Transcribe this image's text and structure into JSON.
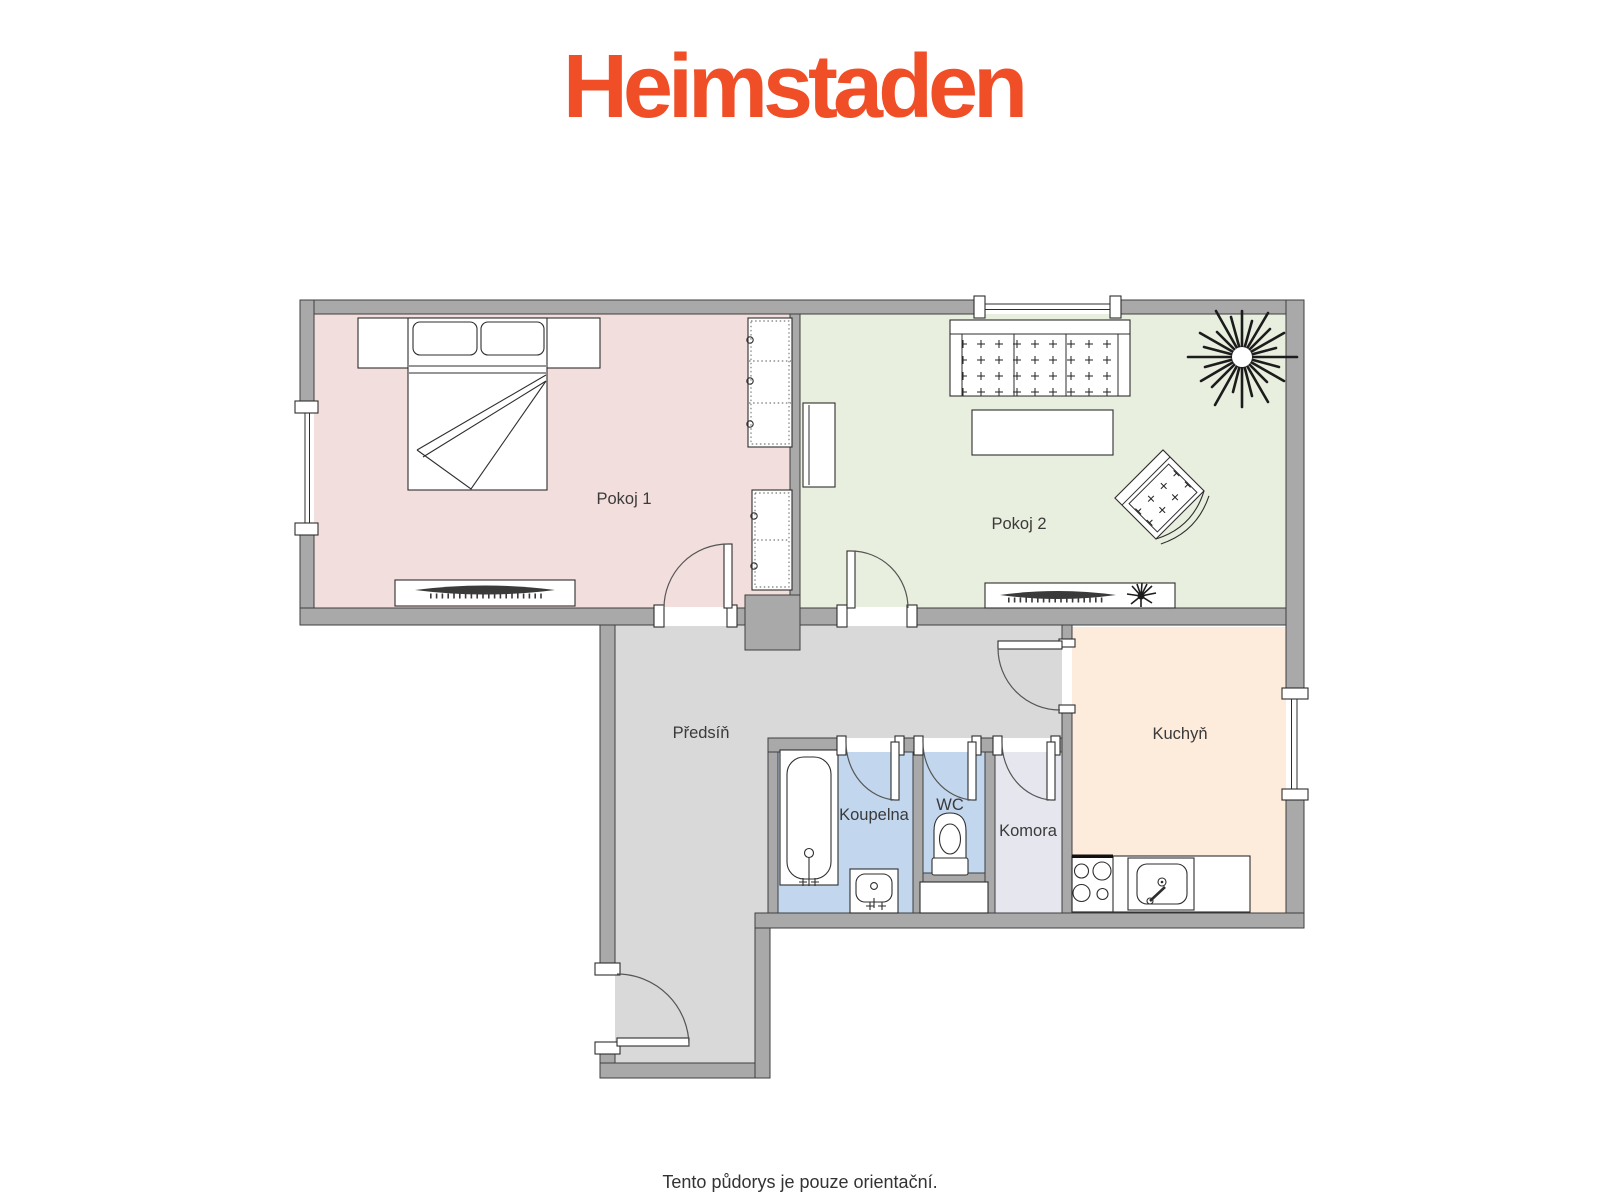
{
  "logo": {
    "text": "Heimstaden",
    "color": "#F04E26"
  },
  "caption": {
    "text": "Tento půdorys je pouze orientační."
  },
  "palette": {
    "wall_fill": "#A9A9A9",
    "wall_outline": "#3F3F3F",
    "line_color": "#2E2E2E",
    "background": "#FFFFFF"
  },
  "rooms": [
    {
      "id": "pokoj-1",
      "label": "Pokoj 1",
      "floor_color": "#F2DEDC"
    },
    {
      "id": "pokoj-2",
      "label": "Pokoj 2",
      "floor_color": "#E9EFDE"
    },
    {
      "id": "predsin",
      "label": "Předsíň",
      "floor_color": "#D9D9D9"
    },
    {
      "id": "koupelna",
      "label": "Koupelna",
      "floor_color": "#C2D6EE"
    },
    {
      "id": "wc",
      "label": "WC",
      "floor_color": "#C2D6EE"
    },
    {
      "id": "komora",
      "label": "Komora",
      "floor_color": "#E6E6EF"
    },
    {
      "id": "kuchyn",
      "label": "Kuchyň",
      "floor_color": "#FDEBDC"
    }
  ]
}
